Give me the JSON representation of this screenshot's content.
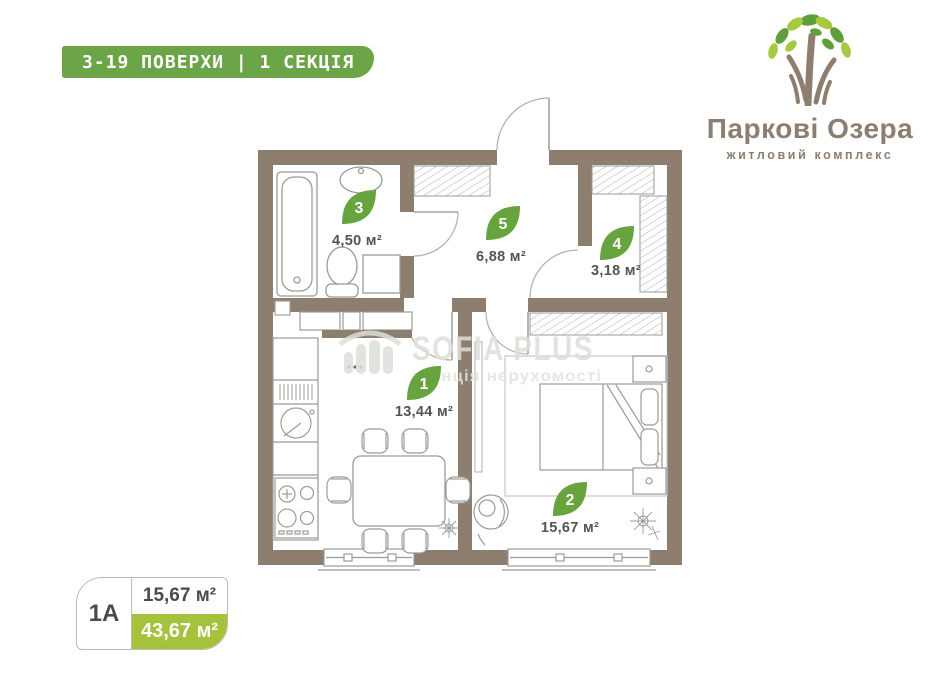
{
  "header": {
    "floors_badge": "3-19 ПОВЕРХИ | 1 СЕКЦІЯ"
  },
  "logo": {
    "title": "Паркові Озера",
    "subtitle": "житловий комплекс"
  },
  "watermark": {
    "title": "SOFIA PLUS",
    "subtitle": "агенція нерухомості"
  },
  "plan": {
    "rooms": [
      {
        "number": "3",
        "area": "4,50 м²",
        "name": "bathroom"
      },
      {
        "number": "5",
        "area": "6,88 м²",
        "name": "hallway"
      },
      {
        "number": "4",
        "area": "3,18 м²",
        "name": "wardrobe"
      },
      {
        "number": "1",
        "area": "13,44 м²",
        "name": "kitchen-living-room"
      },
      {
        "number": "2",
        "area": "15,67 м²",
        "name": "bedroom"
      }
    ]
  },
  "unit_badge": {
    "code": "1А",
    "living_area": "15,67 м²",
    "total_area": "43,67 м²"
  },
  "colors": {
    "wall": "#8d7e70",
    "leaf_green": "#67a43e",
    "header_green": "#6ca448",
    "badge_lime": "#a6c23c",
    "brand_taupe": "#8d7e70"
  }
}
